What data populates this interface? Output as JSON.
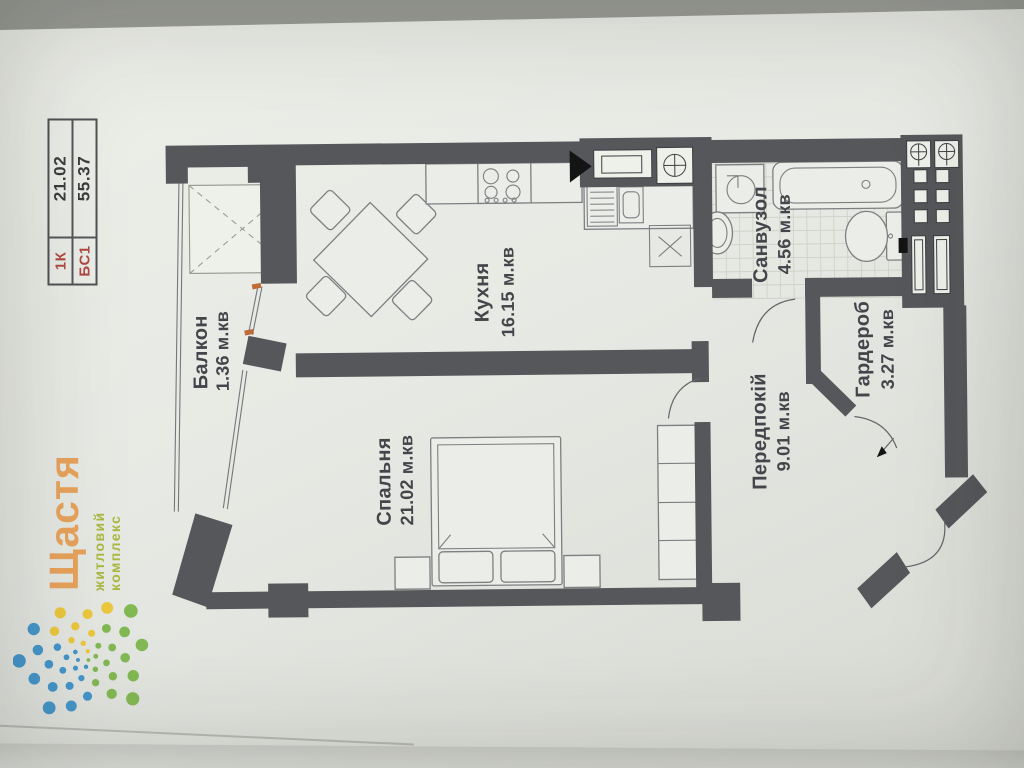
{
  "info_table": {
    "rows": [
      {
        "label": "1К",
        "value": "21.02"
      },
      {
        "label": "БС1",
        "value": "55.37"
      }
    ]
  },
  "logo": {
    "title": "Щастя",
    "subtitle": "житловий комплекс"
  },
  "plan": {
    "rooms": [
      {
        "id": "kitchen",
        "name": "Кухня",
        "area": "16.15 м.кв"
      },
      {
        "id": "balcony",
        "name": "Балкон",
        "area": "1.36 м.кв"
      },
      {
        "id": "bedroom",
        "name": "Спальня",
        "area": "21.02 м.кв"
      },
      {
        "id": "bathroom",
        "name": "Санвузол",
        "area": "4.56 м.кв"
      },
      {
        "id": "hallway",
        "name": "Передпокій",
        "area": "9.01 м.кв"
      },
      {
        "id": "wardrobe",
        "name": "Гардероб",
        "area": "3.27 м.кв"
      }
    ]
  },
  "colors": {
    "wall": "#55575a",
    "paper": "#e7e9e4",
    "photobg": "#9a9c96",
    "labeltext": "#43454a",
    "redlabel": "#b04a42",
    "orangetick": "#c06a38",
    "furniture": "#7d7f82",
    "tile": "#cdcfc4",
    "logoorange": "#e8a35c",
    "logogreen": "#a9b93f",
    "dotblue": "#4597cc",
    "dotgreen": "#83b954",
    "dotyellow": "#ecc83d"
  }
}
